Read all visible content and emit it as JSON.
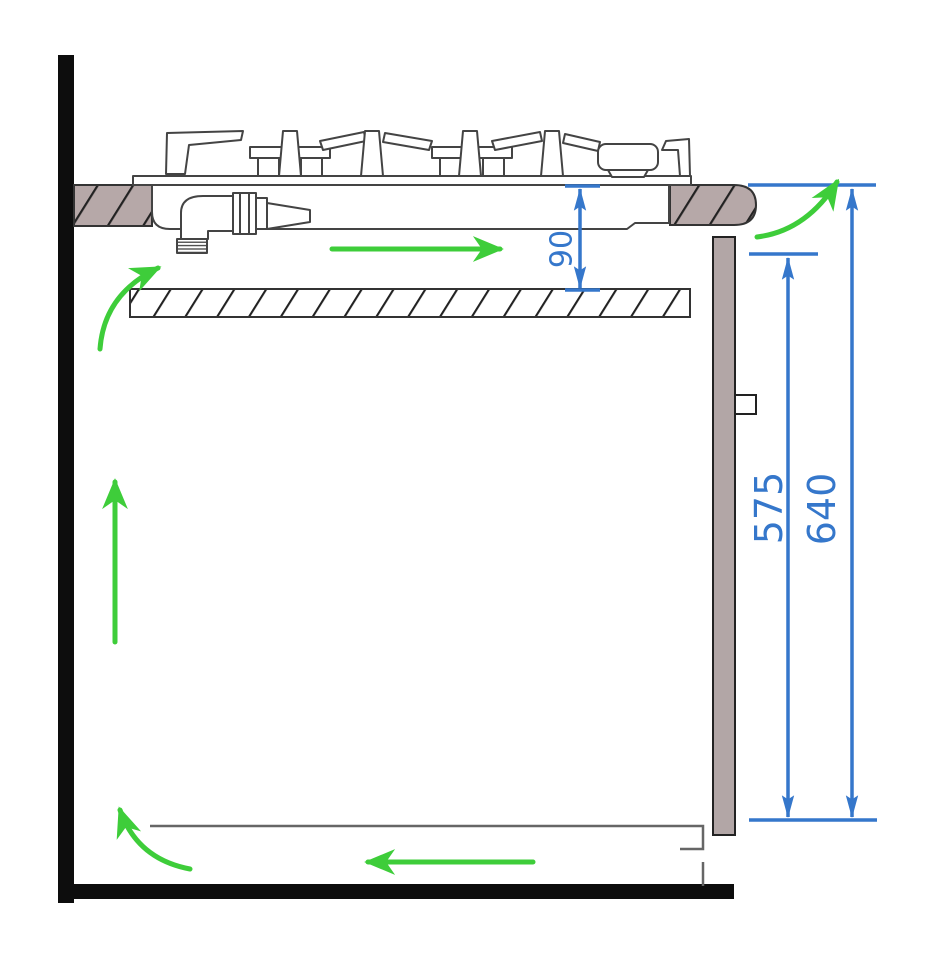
{
  "diagram": {
    "title": "hob-installation-clearance-drawing",
    "dimensions": {
      "hob_to_shelf_gap": "90",
      "panel_clearance": "575",
      "total_clearance": "640"
    },
    "colors": {
      "dimension_blue": "#3577cb",
      "airflow_green": "#3ecd3a",
      "countertop_fill": "#b6a8a8",
      "panel_fill": "#b2a6a6",
      "drawing_outline": "#444444",
      "structure_black": "#0d0d0d"
    },
    "icons": {
      "airflow_arrows": [
        "airflow-under-hob-right-arrow",
        "airflow-mid-left-curve-up-arrow",
        "airflow-left-riser-up-arrow",
        "airflow-bottom-leftward-arrow",
        "airflow-bottom-left-curve-up-arrow",
        "airflow-top-right-curve-up-arrow"
      ]
    }
  }
}
